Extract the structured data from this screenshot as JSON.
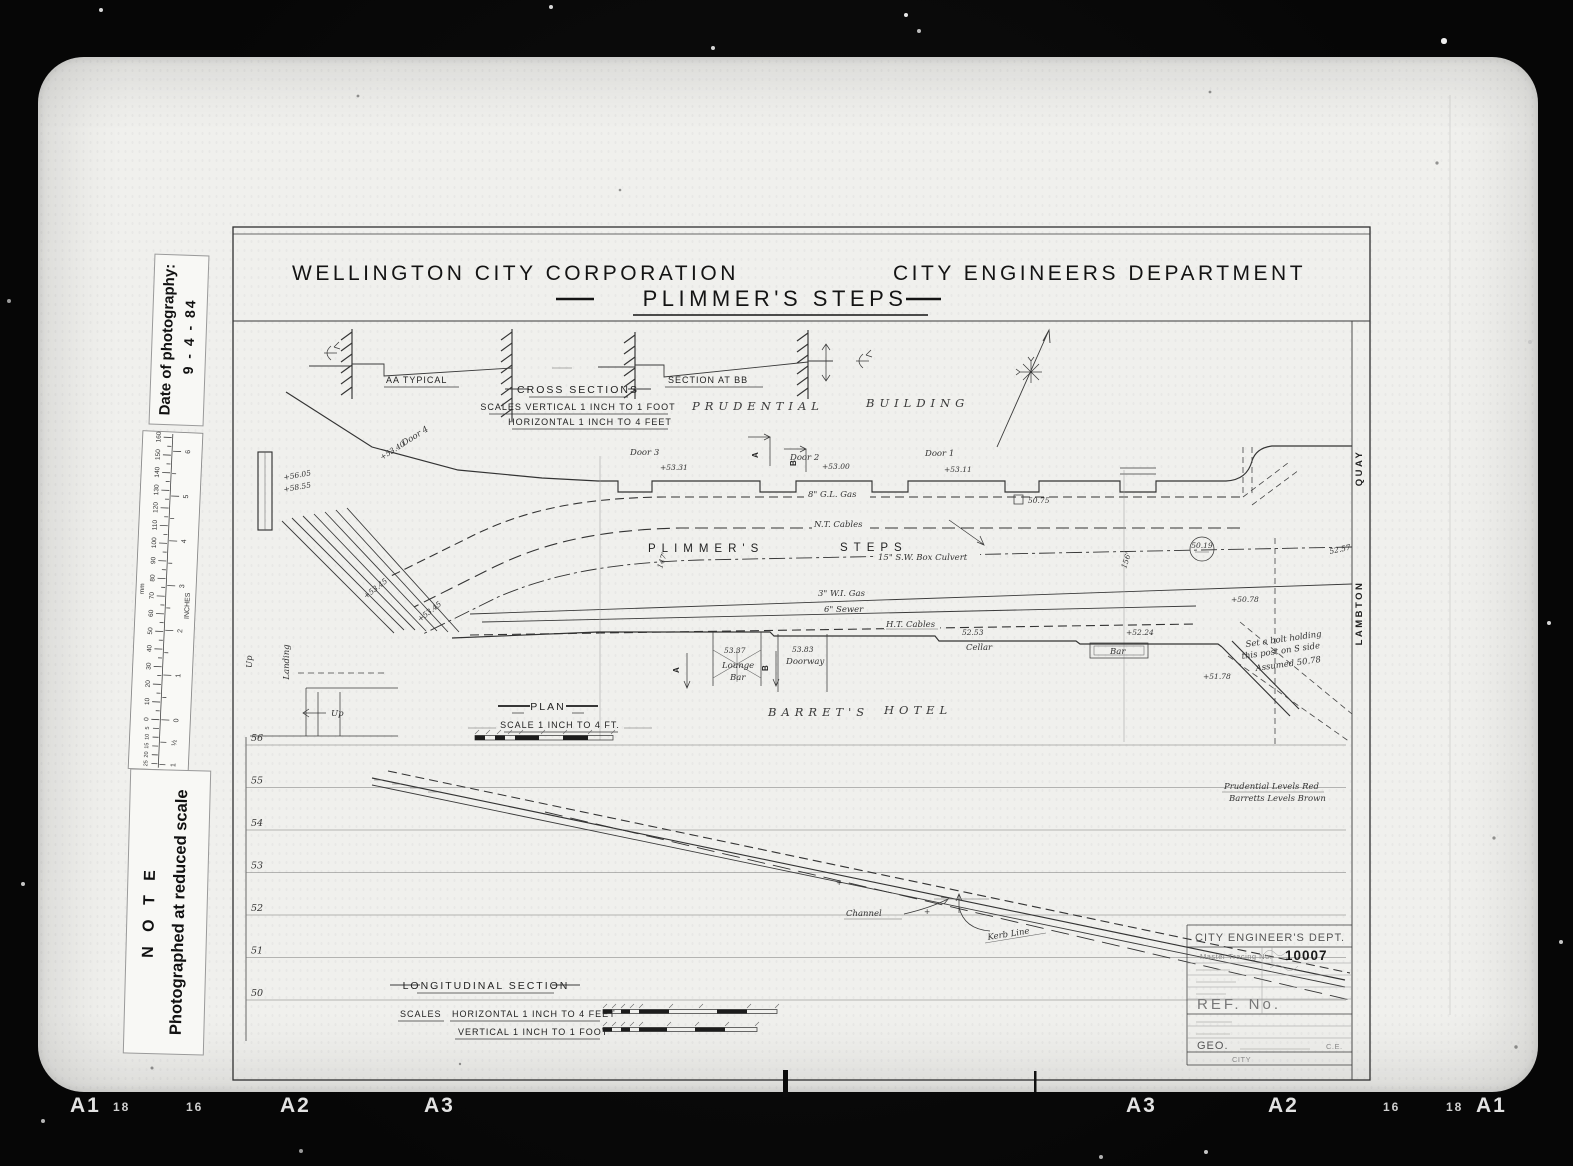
{
  "film": {
    "bottom_marks_left": [
      "A1",
      "18",
      "16",
      "A2",
      "A3"
    ],
    "bottom_marks_right": [
      "A3",
      "A2",
      "16",
      "18",
      "A1"
    ]
  },
  "side_labels": {
    "date_title": "Date of photography:",
    "date_value": "9 - 4 - 84",
    "note_title": "N O T E",
    "note_body": "Photographed at reduced scale"
  },
  "ruler": {
    "mm_title": "mm",
    "inch_title": "INCHES",
    "mm_ticks": [
      "0",
      "10",
      "20",
      "30",
      "40",
      "50",
      "60",
      "70",
      "80",
      "90",
      "100",
      "110",
      "120",
      "130",
      "140",
      "150",
      "160"
    ],
    "mm_below_ticks": [
      "5",
      "10",
      "15",
      "20",
      "25",
      "30"
    ],
    "inch_ticks": [
      "0",
      "1",
      "2",
      "3",
      "4",
      "5",
      "6"
    ],
    "inch_below_ticks": [
      "½",
      "1"
    ]
  },
  "header": {
    "organisation": "WELLINGTON CITY CORPORATION",
    "department": "CITY ENGINEERS DEPARTMENT",
    "title": "PLIMMER'S STEPS"
  },
  "cross_sections": {
    "aa_label": "AA TYPICAL",
    "bb_label": "SECTION AT BB",
    "heading": "CROSS SECTIONS",
    "scales_line1": "SCALES VERTICAL 1 INCH TO 1 FOOT",
    "scales_line2": "HORIZONTAL 1 INCH TO 4 FEET"
  },
  "plan": {
    "heading": "PLAN",
    "scale_note": "SCALE 1 INCH TO 4 FT.",
    "building_word1": "PRUDENTIAL",
    "building_word2": "BUILDING",
    "hotel_word1": "BARRET'S",
    "hotel_word2": "HOTEL",
    "steps_word1": "PLIMMER'S",
    "steps_word2": "STEPS",
    "street_word1": "QUAY",
    "street_word2": "LAMBTON",
    "doors": {
      "door1": "Door 1",
      "door1_level": "+53.11",
      "door2": "Door 2",
      "door2_level": "+53.00",
      "door3": "Door 3",
      "door3_level": "+53.31",
      "door4": "Door 4",
      "door4_level": "+53.40"
    },
    "services": {
      "gas8": "8\" G.L. Gas",
      "nt_cables": "N.T. Cables",
      "culvert": "15\" S.W. Box Culvert",
      "gas3": "3\" W.I. Gas",
      "sewer": "6\" Sewer",
      "ht_cables": "H.T. Cables"
    },
    "rooms": {
      "lounge_level": "53.37",
      "lounge_word1": "Lounge",
      "lounge_word2": "Bar",
      "doorway_level": "53.83",
      "doorway": "Doorway",
      "cellar": "Cellar",
      "cellar_level": "52.53",
      "bar": "Bar",
      "bar_level": "+52.24"
    },
    "levels": {
      "top1": "+56.05",
      "top2": "+58.55",
      "steps_a": "+53.45",
      "steps_b": "+53.45",
      "circle_value": "50.19",
      "boxed_value": "50.75",
      "quay_a": "+50.78",
      "quay_b": "+51.78",
      "margin_value": "52.57"
    },
    "chainage1": "147'",
    "chainage2": "156'",
    "landing": "Landing",
    "up": "Up",
    "section_a": "A",
    "section_b": "B",
    "bolt_note_line1": "Set a bolt holding",
    "bolt_note_line2": "this post on S side",
    "bolt_note_line3": "Assumed 50.78"
  },
  "long_section": {
    "heading": "LONGITUDINAL SECTION",
    "scales_word": "SCALES",
    "scale_h": "HORIZONTAL 1 INCH TO 4 FEET",
    "scale_v": "VERTICAL 1 INCH TO 1 FOOT",
    "levels": [
      "56",
      "55",
      "54",
      "53",
      "52",
      "51",
      "50"
    ],
    "plus_mark": "+",
    "channel": "Channel",
    "kerb_line": "Kerb Line",
    "note_line1": "Prudential Levels Red",
    "note_line2": "Barretts Levels Brown"
  },
  "title_block": {
    "dept": "CITY ENGINEER'S DEPT.",
    "tracing_label": "Master Tracing No.",
    "tracing_number": "10007",
    "ref_label": "REF. No.",
    "sig_prefix": "GEO.",
    "sig_suffix": "C.E.",
    "footer": "CITY"
  }
}
